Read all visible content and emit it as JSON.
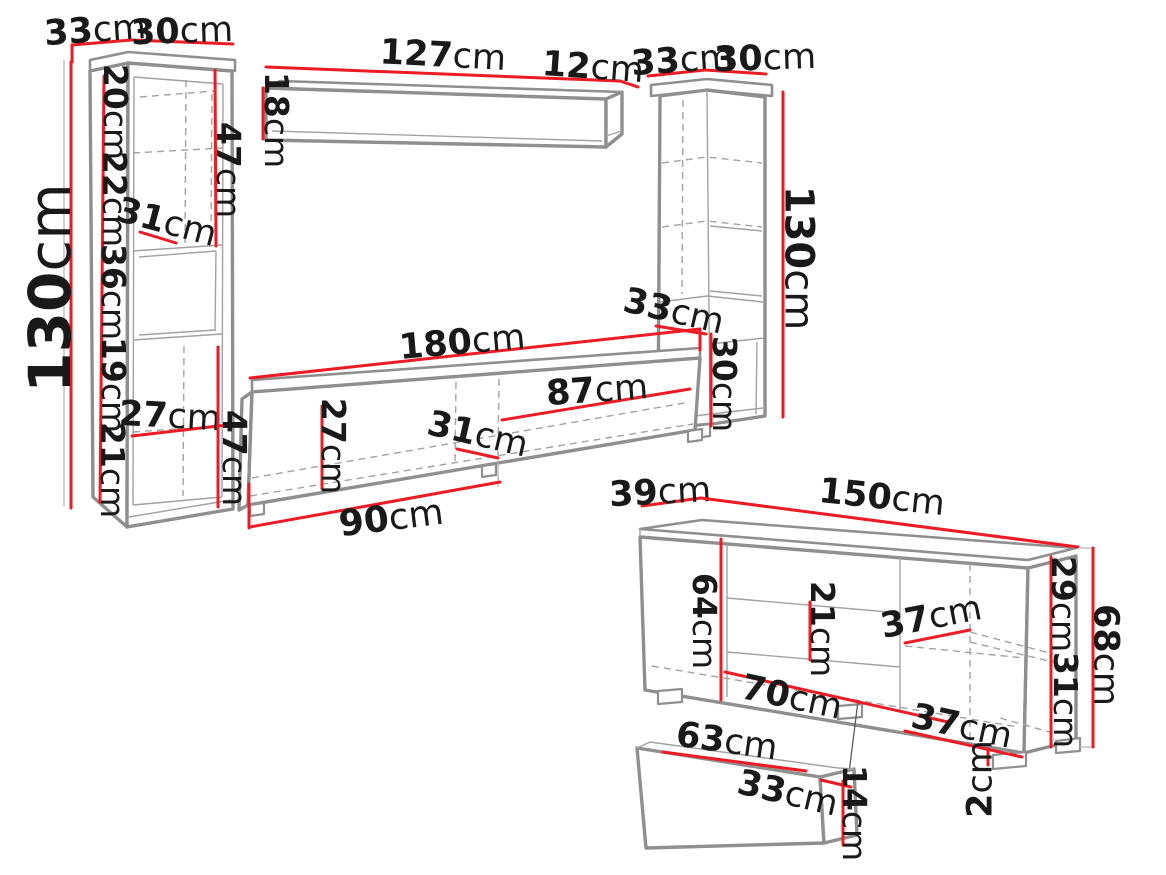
{
  "diagram": {
    "kind": "furniture-dimension-diagram",
    "unit_default": "cm",
    "colors": {
      "dimension_red": "#ed1c24",
      "outline_gray": "#8f8f8f",
      "label_black": "#191919",
      "background": "#ffffff"
    },
    "pieces": [
      {
        "id": "left-cabinet"
      },
      {
        "id": "wall-shelf"
      },
      {
        "id": "right-cabinet"
      },
      {
        "id": "tv-stand"
      },
      {
        "id": "sideboard"
      },
      {
        "id": "drawer"
      }
    ],
    "dimensions": [
      {
        "piece": "left-cabinet",
        "value": "33",
        "unit": "cm",
        "x": 95,
        "y": 29,
        "rot": -4,
        "size": 35,
        "lines": [
          [
            [
              72,
              45
            ],
            [
              131,
              40
            ]
          ],
          [
            [
              72,
              45
            ],
            [
              72,
              62
            ]
          ]
        ]
      },
      {
        "piece": "left-cabinet",
        "value": "30",
        "unit": "cm",
        "x": 182,
        "y": 30,
        "rot": -2,
        "size": 35,
        "lines": [
          [
            [
              131,
              40
            ],
            [
              233,
              44
            ]
          ]
        ]
      },
      {
        "piece": "left-cabinet",
        "value": "130",
        "unit": "cm",
        "x": 49,
        "y": 288,
        "rot": -90,
        "size": 58,
        "lines": [
          [
            [
              71,
              62
            ],
            [
              71,
              508
            ]
          ]
        ]
      },
      {
        "piece": "left-cabinet",
        "value": "20",
        "unit": "cm",
        "x": 116,
        "y": 112,
        "rot": 90,
        "size": 33,
        "lines": [
          [
            [
              104,
              76
            ],
            [
              100,
              502
            ]
          ]
        ]
      },
      {
        "piece": "left-cabinet",
        "value": "22",
        "unit": "cm",
        "x": 115,
        "y": 199,
        "rot": 90,
        "size": 33,
        "lines": []
      },
      {
        "piece": "left-cabinet",
        "value": "36",
        "unit": "cm",
        "x": 114,
        "y": 292,
        "rot": 90,
        "size": 33,
        "lines": []
      },
      {
        "piece": "left-cabinet",
        "value": "19",
        "unit": "cm",
        "x": 114,
        "y": 385,
        "rot": 90,
        "size": 33,
        "lines": []
      },
      {
        "piece": "left-cabinet",
        "value": "21",
        "unit": "cm",
        "x": 113,
        "y": 470,
        "rot": 90,
        "size": 33,
        "lines": []
      },
      {
        "piece": "left-cabinet",
        "value": "31",
        "unit": "cm",
        "x": 167,
        "y": 221,
        "rot": 15,
        "size": 35,
        "lines": [
          [
            [
              140,
              232
            ],
            [
              176,
              243
            ]
          ]
        ]
      },
      {
        "piece": "left-cabinet",
        "value": "47",
        "unit": "cm",
        "x": 229,
        "y": 170,
        "rot": 90,
        "size": 33,
        "lines": [
          [
            [
              215,
              70
            ],
            [
              216,
              246
            ]
          ]
        ]
      },
      {
        "piece": "left-cabinet",
        "value": "27",
        "unit": "cm",
        "x": 170,
        "y": 415,
        "rot": 3,
        "size": 35,
        "lines": [
          [
            [
              132,
              436
            ],
            [
              227,
              425
            ]
          ]
        ]
      },
      {
        "piece": "wall-shelf",
        "value": "127",
        "unit": "cm",
        "x": 443,
        "y": 54,
        "rot": 3,
        "size": 35,
        "lines": [
          [
            [
              266,
              67
            ],
            [
              620,
              81
            ]
          ]
        ]
      },
      {
        "piece": "wall-shelf",
        "value": "12",
        "unit": "cm",
        "x": 593,
        "y": 66,
        "rot": 4,
        "size": 35,
        "lines": [
          [
            [
              620,
              81
            ],
            [
              638,
              87
            ]
          ]
        ]
      },
      {
        "piece": "wall-shelf",
        "value": "18",
        "unit": "cm",
        "x": 277,
        "y": 120,
        "rot": 90,
        "size": 33,
        "lines": [
          [
            [
              263,
              88
            ],
            [
              263,
              139
            ]
          ]
        ]
      },
      {
        "piece": "right-cabinet",
        "value": "33",
        "unit": "cm",
        "x": 682,
        "y": 59,
        "rot": -4,
        "size": 35,
        "lines": [
          [
            [
              648,
              76
            ],
            [
              705,
              70
            ]
          ]
        ]
      },
      {
        "piece": "right-cabinet",
        "value": "30",
        "unit": "cm",
        "x": 765,
        "y": 57,
        "rot": -2,
        "size": 35,
        "lines": [
          [
            [
              705,
              70
            ],
            [
              766,
              74
            ]
          ]
        ]
      },
      {
        "piece": "right-cabinet",
        "value": "130",
        "unit": "cm",
        "x": 800,
        "y": 258,
        "rot": 90,
        "size": 40,
        "lines": [
          [
            [
              783,
              92
            ],
            [
              783,
              417
            ]
          ]
        ]
      },
      {
        "piece": "right-cabinet",
        "value": "33",
        "unit": "cm",
        "x": 674,
        "y": 310,
        "rot": 13,
        "size": 35,
        "lines": [
          [
            [
              656,
              326
            ],
            [
              706,
              334
            ]
          ]
        ]
      },
      {
        "piece": "right-cabinet",
        "value": "30",
        "unit": "cm",
        "x": 725,
        "y": 384,
        "rot": 90,
        "size": 33,
        "lines": [
          [
            [
              711,
              334
            ],
            [
              711,
              426
            ]
          ]
        ]
      },
      {
        "piece": "tv-stand",
        "value": "180",
        "unit": "cm",
        "x": 462,
        "y": 341,
        "rot": -5,
        "size": 35,
        "lines": [
          [
            [
              250,
              378
            ],
            [
              700,
              329
            ]
          ],
          [
            [
              700,
              329
            ],
            [
              700,
              350
            ]
          ]
        ]
      },
      {
        "piece": "tv-stand",
        "value": "87",
        "unit": "cm",
        "x": 597,
        "y": 389,
        "rot": -4,
        "size": 35,
        "lines": [
          [
            [
              502,
              420
            ],
            [
              690,
              389
            ]
          ]
        ]
      },
      {
        "piece": "tv-stand",
        "value": "27",
        "unit": "cm",
        "x": 334,
        "y": 446,
        "rot": 90,
        "size": 33,
        "lines": [
          [
            [
              322,
              406
            ],
            [
              322,
              489
            ]
          ]
        ]
      },
      {
        "piece": "tv-stand",
        "value": "31",
        "unit": "cm",
        "x": 478,
        "y": 433,
        "rot": 13,
        "size": 35,
        "lines": [
          [
            [
              457,
              449
            ],
            [
              498,
              458
            ]
          ]
        ]
      },
      {
        "piece": "tv-stand",
        "value": "90",
        "unit": "cm",
        "x": 391,
        "y": 517,
        "rot": -7,
        "size": 36,
        "lines": [
          [
            [
              250,
              527
            ],
            [
              500,
              482
            ]
          ],
          [
            [
              249,
              484
            ],
            [
              249,
              528
            ]
          ]
        ]
      },
      {
        "piece": "tv-stand",
        "value": "47",
        "unit": "cm",
        "x": 235,
        "y": 458,
        "rot": 90,
        "size": 33,
        "lines": [
          [
            [
              218,
              347
            ],
            [
              218,
              507
            ]
          ]
        ]
      },
      {
        "piece": "sideboard",
        "value": "39",
        "unit": "cm",
        "x": 660,
        "y": 491,
        "rot": -3,
        "size": 35,
        "lines": [
          [
            [
              642,
              506
            ],
            [
              701,
              498
            ]
          ]
        ]
      },
      {
        "piece": "sideboard",
        "value": "150",
        "unit": "cm",
        "x": 882,
        "y": 496,
        "rot": 6,
        "size": 35,
        "lines": [
          [
            [
              701,
              498
            ],
            [
              1078,
              547
            ]
          ]
        ]
      },
      {
        "piece": "sideboard",
        "value": "64",
        "unit": "cm",
        "x": 705,
        "y": 621,
        "rot": 90,
        "size": 33,
        "lines": [
          [
            [
              721,
              539
            ],
            [
              721,
              700
            ]
          ]
        ]
      },
      {
        "piece": "sideboard",
        "value": "21",
        "unit": "cm",
        "x": 823,
        "y": 629,
        "rot": 90,
        "size": 33,
        "lines": [
          [
            [
              810,
              602
            ],
            [
              810,
              660
            ]
          ]
        ]
      },
      {
        "piece": "sideboard",
        "value": "37",
        "unit": "cm",
        "x": 931,
        "y": 616,
        "rot": -11,
        "size": 35,
        "lines": [
          [
            [
              905,
              643
            ],
            [
              970,
              630
            ]
          ]
        ]
      },
      {
        "piece": "sideboard",
        "value": "70",
        "unit": "cm",
        "x": 792,
        "y": 696,
        "rot": 12,
        "size": 35,
        "lines": [
          [
            [
              725,
              672
            ],
            [
              948,
              722
            ]
          ]
        ]
      },
      {
        "piece": "sideboard",
        "value": "37",
        "unit": "cm",
        "x": 962,
        "y": 725,
        "rot": 12,
        "size": 35,
        "lines": [
          [
            [
              905,
              731
            ],
            [
              1022,
              757
            ]
          ]
        ]
      },
      {
        "piece": "sideboard",
        "value": "29",
        "unit": "cm",
        "x": 1064,
        "y": 604,
        "rot": 90,
        "size": 33,
        "lines": [
          [
            [
              1051,
              557
            ],
            [
              1051,
              747
            ]
          ]
        ]
      },
      {
        "piece": "sideboard",
        "value": "31",
        "unit": "cm",
        "x": 1066,
        "y": 700,
        "rot": 90,
        "size": 33,
        "lines": []
      },
      {
        "piece": "sideboard",
        "value": "68",
        "unit": "cm",
        "x": 1107,
        "y": 655,
        "rot": 90,
        "size": 35,
        "lines": [
          [
            [
              1093,
              548
            ],
            [
              1093,
              747
            ]
          ]
        ]
      },
      {
        "piece": "sideboard",
        "value": "2",
        "unit": "cm",
        "x": 979,
        "y": 779,
        "rot": -90,
        "size": 35,
        "lines": [
          [
            [
              988,
              749
            ],
            [
              988,
              765
            ]
          ]
        ]
      },
      {
        "piece": "drawer",
        "value": "63",
        "unit": "cm",
        "x": 727,
        "y": 740,
        "rot": 8,
        "size": 35,
        "lines": [
          [
            [
              663,
              752
            ],
            [
              806,
              771
            ]
          ]
        ]
      },
      {
        "piece": "drawer",
        "value": "33",
        "unit": "cm",
        "x": 788,
        "y": 792,
        "rot": 13,
        "size": 35,
        "lines": [
          [
            [
              821,
              780
            ],
            [
              851,
              787
            ]
          ]
        ]
      },
      {
        "piece": "drawer",
        "value": "14",
        "unit": "cm",
        "x": 855,
        "y": 813,
        "rot": 90,
        "size": 33,
        "lines": [
          [
            [
              843,
              781
            ],
            [
              843,
              845
            ]
          ]
        ]
      }
    ]
  }
}
